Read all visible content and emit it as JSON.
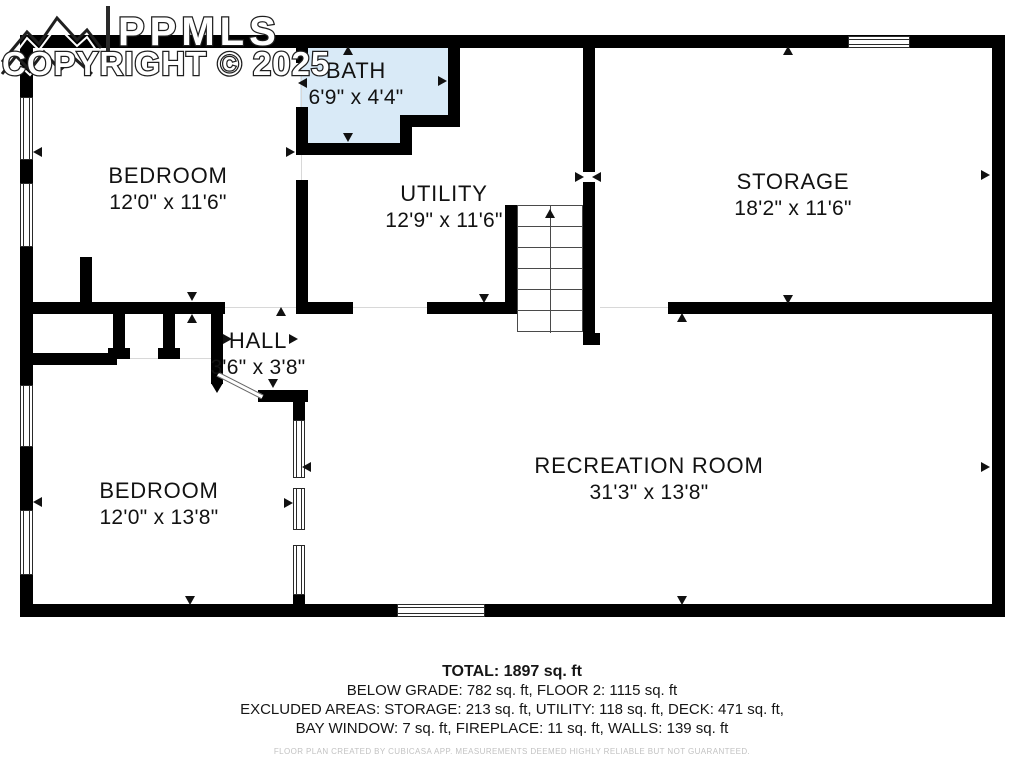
{
  "watermark": {
    "brand": "PPMLS",
    "copyright": "COPYRIGHT © 2025",
    "logo": "mountain-range-icon"
  },
  "rooms": {
    "bath": {
      "label": "BATH",
      "dims": "6'9\" x 4'4\""
    },
    "bedroom_upper": {
      "label": "BEDROOM",
      "dims": "12'0\" x 11'6\""
    },
    "utility": {
      "label": "UTILITY",
      "dims": "12'9\" x 11'6\""
    },
    "storage": {
      "label": "STORAGE",
      "dims": "18'2\" x 11'6\""
    },
    "hall": {
      "label": "HALL",
      "dims": "3'6\" x 3'8\""
    },
    "bedroom_lower": {
      "label": "BEDROOM",
      "dims": "12'0\" x 13'8\""
    },
    "recreation": {
      "label": "RECREATION ROOM",
      "dims": "31'3\" x 13'8\""
    }
  },
  "summary": {
    "total": "TOTAL: 1897 sq. ft",
    "below_grade_line": "BELOW GRADE: 782 sq. ft, FLOOR 2: 1115 sq. ft",
    "excluded_line1": "EXCLUDED AREAS: STORAGE: 213 sq. ft, UTILITY: 118 sq. ft, DECK: 471 sq. ft,",
    "excluded_line2": "BAY WINDOW: 7 sq. ft, FIREPLACE: 11 sq. ft, WALLS: 139 sq. ft",
    "disclaimer": "FLOOR PLAN CREATED BY CUBICASA APP. MEASUREMENTS DEEMED HIGHLY RELIABLE BUT NOT GUARANTEED."
  },
  "colors": {
    "wall": "#000000",
    "bath_fill": "#d9eaf7",
    "stair_line": "#4a4a4a",
    "disclaimer_text": "#c2c2c2"
  }
}
